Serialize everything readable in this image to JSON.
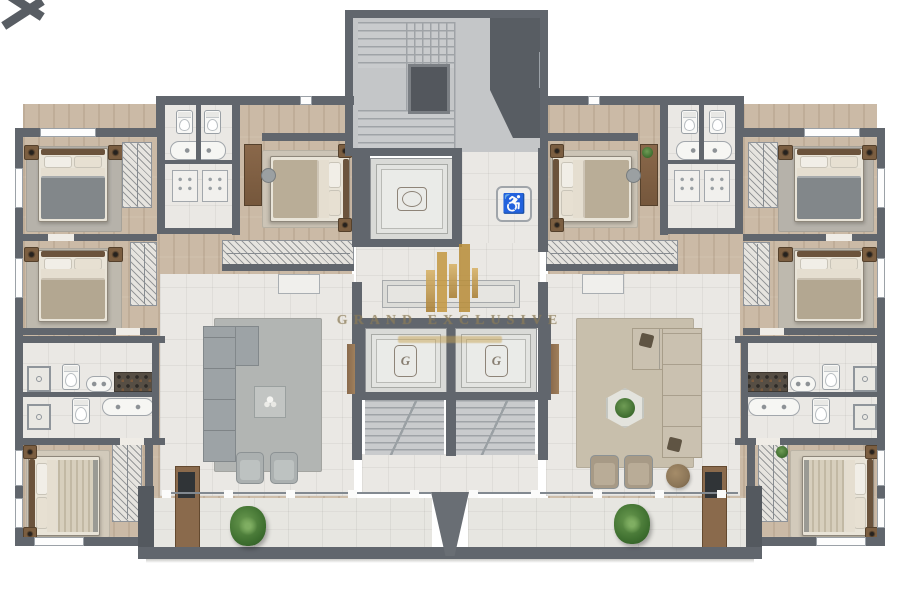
{
  "watermark": {
    "brand": "GRAND EXCLUSIVE",
    "monogram": "G",
    "logo_icon": "gold-towers-logo",
    "gold": "#c9a24b"
  },
  "symbols": {
    "accessibility_icon": "wheelchair-icon",
    "accessibility_glyph": "♿",
    "elevator_crest_icon": "oval-crest",
    "plant_icon": "potted-plant",
    "stairs_icon": "stair-flight"
  },
  "palette": {
    "background": "#ffffff",
    "wall": "#61666d",
    "wall_dark": "#54595f",
    "wood_floor": "#cbbaa6",
    "tile_floor": "#eae8e4",
    "stair_floor": "#c4c6c8",
    "rug_gray": "#b6b2aa",
    "rug_beige": "#c8bfac",
    "sofa_gray": "#9da3a6",
    "sofa_beige": "#cac1b0",
    "wood_furniture": "#7b5e41",
    "greenery": "#3f7030"
  },
  "inventory": {
    "elevators": 3,
    "stair_flights": 3,
    "bedrooms": 8,
    "bath_zones": 4,
    "living_areas": 2,
    "balconies": 2,
    "balcony_plants": 2
  }
}
